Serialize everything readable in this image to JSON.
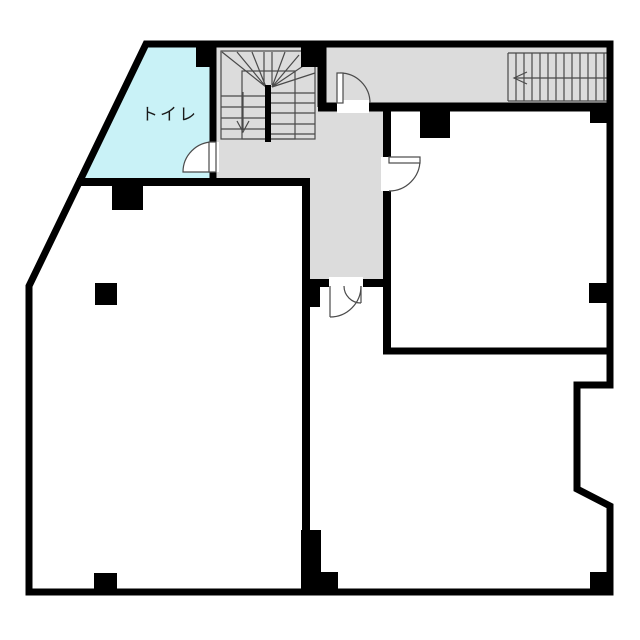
{
  "plan": {
    "toilet_label": "トイレ",
    "colors": {
      "wall": "#000000",
      "corridor_fill": "#dcdcdc",
      "toilet_fill": "#c9f2f7",
      "room_fill": "#ffffff",
      "detail_line": "#4a4a4a"
    },
    "stairs": {
      "u_stair_direction_arrow": "down",
      "straight_stair_direction_arrow": "left"
    }
  }
}
